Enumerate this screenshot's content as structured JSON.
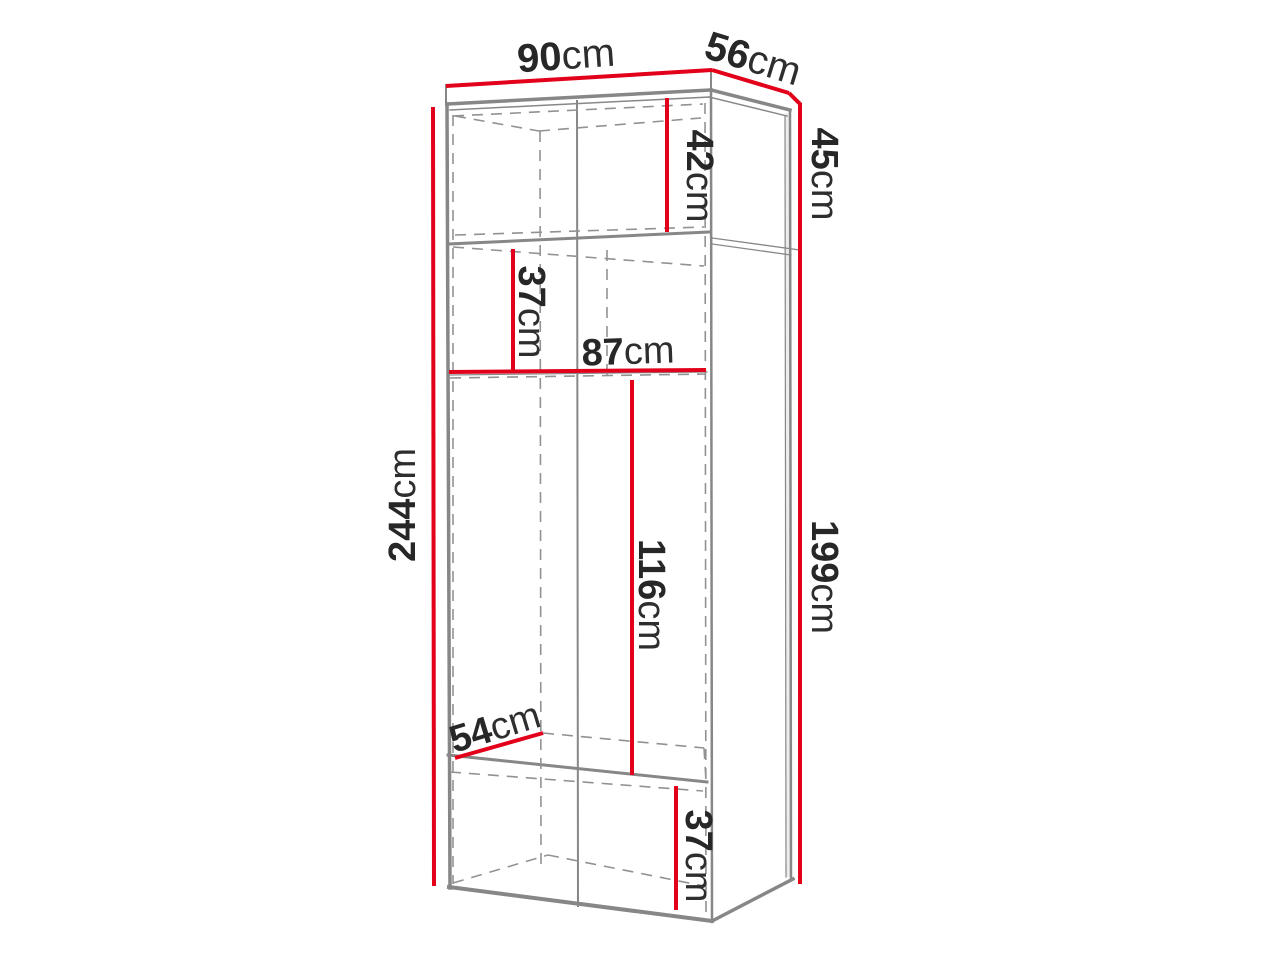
{
  "title": "Wardrobe dimensions diagram",
  "colors": {
    "dimension_red": "#e2001a",
    "structure_gray": "#878787",
    "dashed_gray": "#929292",
    "label_text": "#272727",
    "background": "#ffffff"
  },
  "dimensions": {
    "top_width": {
      "value": "90",
      "unit": "cm"
    },
    "top_depth": {
      "value": "56",
      "unit": "cm"
    },
    "upper_section_height": {
      "value": "45",
      "unit": "cm"
    },
    "upper_inner_height": {
      "value": "42",
      "unit": "cm"
    },
    "shelf_spacing": {
      "value": "37",
      "unit": "cm"
    },
    "interior_width": {
      "value": "87",
      "unit": "cm"
    },
    "total_height": {
      "value": "244",
      "unit": "cm"
    },
    "hanging_height": {
      "value": "116",
      "unit": "cm"
    },
    "lower_section_height": {
      "value": "199",
      "unit": "cm"
    },
    "interior_depth": {
      "value": "54",
      "unit": "cm"
    },
    "bottom_inner_height": {
      "value": "37",
      "unit": "cm"
    }
  }
}
